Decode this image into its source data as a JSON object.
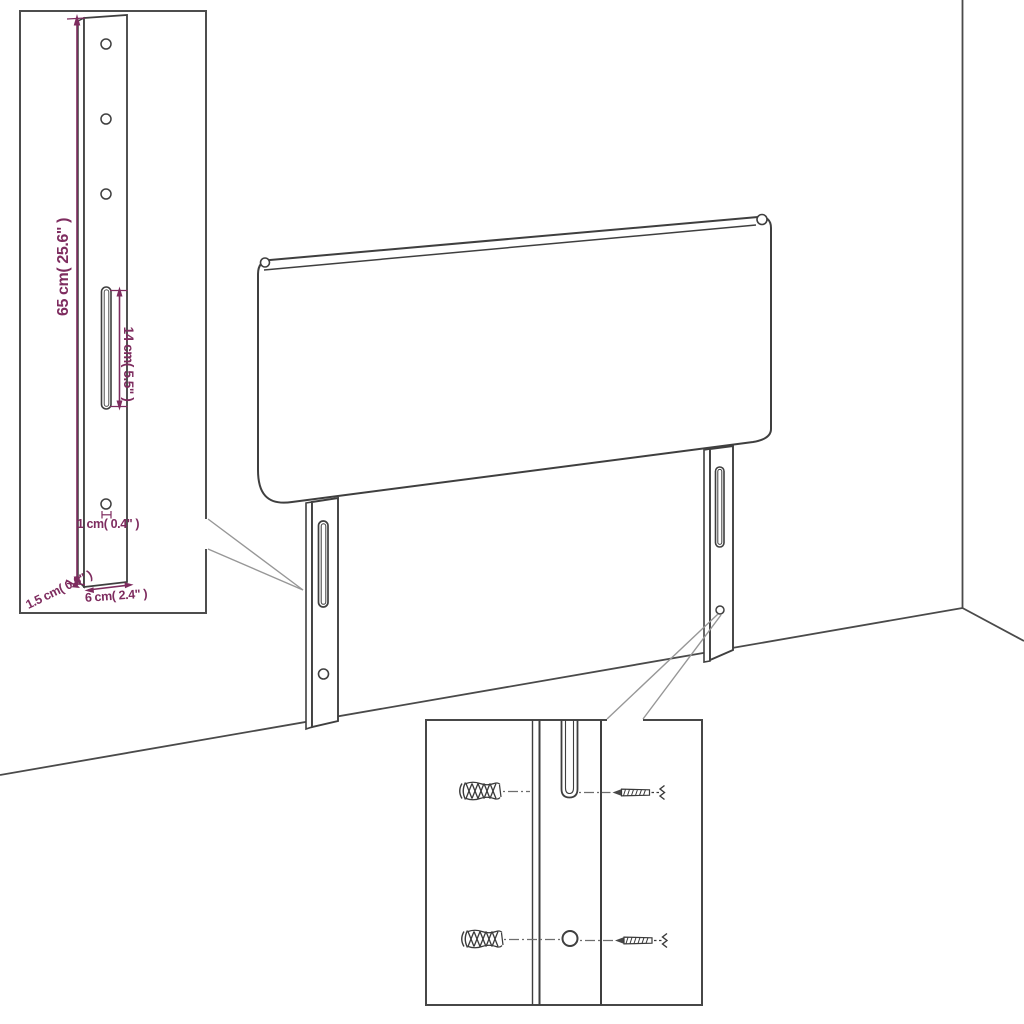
{
  "page": {
    "title": "Headboard product dimension diagram",
    "background": "#ffffff"
  },
  "colors": {
    "dimension_accent": "#7e2c5f",
    "drawing_line": "#3f3f3f",
    "callout_line": "#979797",
    "dashed_line": "#6e6e6e"
  },
  "main_view": {
    "subject": "upholstered headboard with two slotted wall-mount legs standing on the floor against a room corner"
  },
  "inset_leg_detail": {
    "labels": {
      "leg_height": "65 cm( 25.6\" )",
      "slot_length": "14 cm( 5.5\" )",
      "hole_diameter": "1 cm( 0.4\" )",
      "leg_thickness": "1.5 cm( 0.6\" )",
      "leg_width": "6 cm( 2.4\" )"
    }
  },
  "inset_mounting_detail": {
    "parts": [
      "wall-plug-anchor",
      "mounting-slot",
      "mounting-hole",
      "screw"
    ]
  }
}
